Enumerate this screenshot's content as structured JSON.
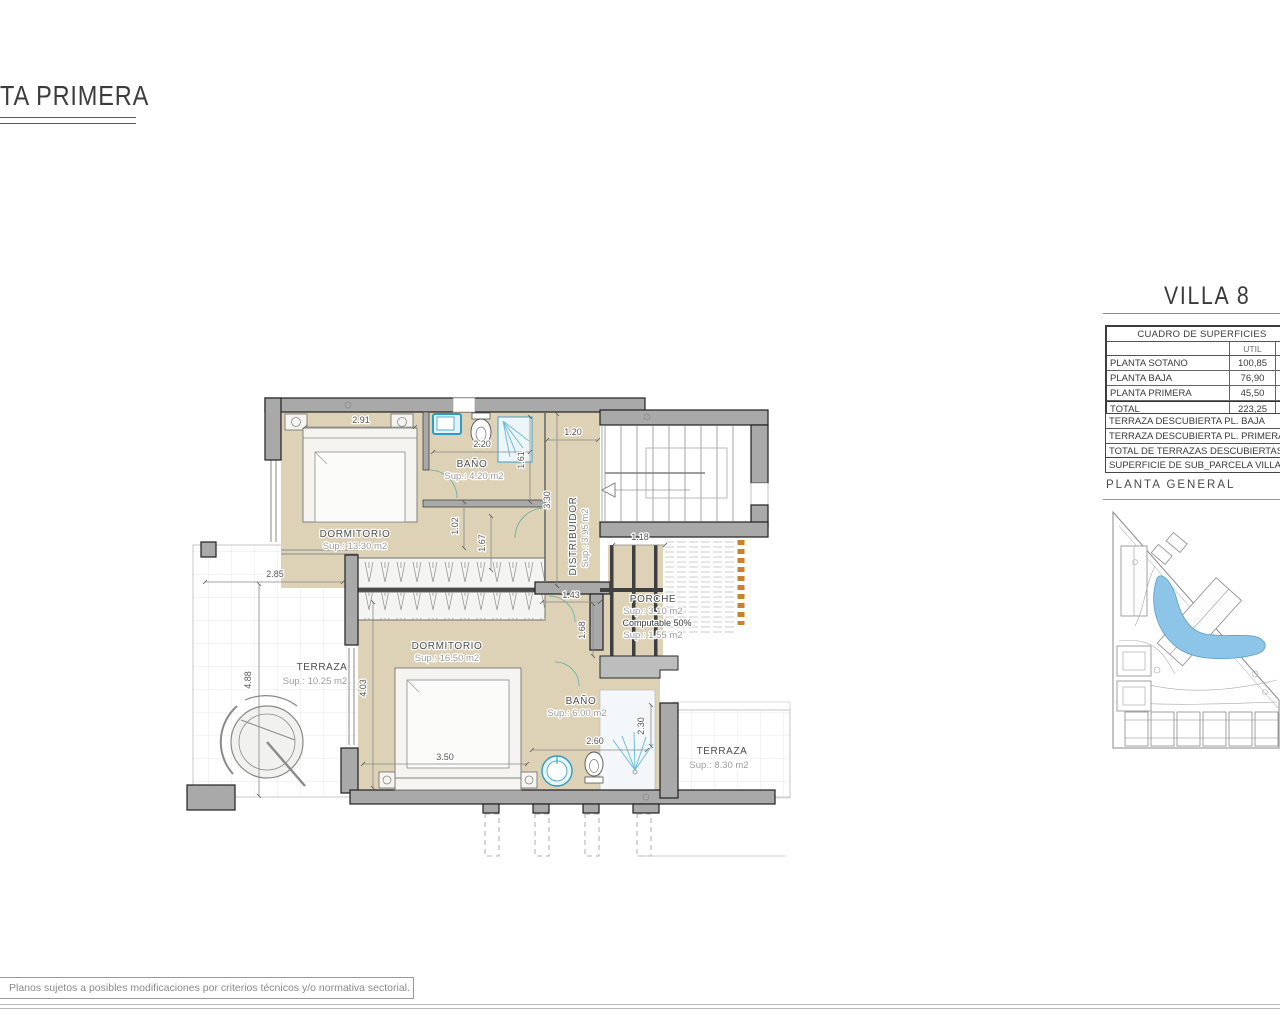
{
  "sheet": {
    "title": "TA PRIMERA",
    "disclaimer": "Planos sujetos a posibles modificaciones por criterios técnicos y/o normativa sectorial."
  },
  "panel": {
    "villa_title": "VILLA 8",
    "surfaces_table": {
      "title": "CUADRO DE SUPERFICIES",
      "col_util": "UTIL",
      "rows": [
        {
          "label": "PLANTA SOTANO",
          "util": "100,85"
        },
        {
          "label": "PLANTA BAJA",
          "util": "76,90"
        },
        {
          "label": "PLANTA PRIMERA",
          "util": "45,50"
        },
        {
          "label": "TOTAL",
          "util": "223,25"
        }
      ]
    },
    "terrace_rows": [
      {
        "label": "TERRAZA DESCUBIERTA PL. BAJA"
      },
      {
        "label": "TERRAZA DESCUBIERTA PL. PRIMERA"
      },
      {
        "label": "TOTAL DE TERRAZAS DESCUBIERTAS"
      }
    ],
    "parcel_row": "SUPERFICIE DE SUB_PARCELA VILLA",
    "planta_general_label": "PLANTA GENERAL"
  },
  "plan": {
    "rooms": {
      "dorm1": {
        "name": "DORMITORIO",
        "sup": "Sup.: 13.30  m2"
      },
      "bath1": {
        "name": "BAÑO",
        "sup": "Sup.: 4.20    m2"
      },
      "distribuidor": {
        "name": "DISTRIBUIDOR",
        "sup": "Sup.: 3.95  m2"
      },
      "dorm2": {
        "name": "DORMITORIO",
        "sup": "Sup.: 16.50  m2"
      },
      "bath2": {
        "name": "BAÑO",
        "sup": "Sup.: 6.00   m2"
      },
      "terrace_left": {
        "name": "TERRAZA",
        "sup": "Sup.: 10.25  m2"
      },
      "terrace_right": {
        "name": "TERRAZA",
        "sup": "Sup.: 8.30   m2"
      },
      "porch": {
        "name": "PORCHE",
        "sup": "Sup.: 3.10   m2",
        "note": "Computable 50%",
        "sup2": "Sup.: 1.55   m2"
      }
    },
    "dims": {
      "bed1_width": "2.91",
      "bath1_width": "2.20",
      "distrib_width": "1.20",
      "shower1_height": "1.61",
      "distrib_height": "3.30",
      "hall1": "1.02",
      "hall2": "1.67",
      "terraceL_width": "2.85",
      "terraceL_height": "4.88",
      "dorm2_door": "1.43",
      "porch_width": "1.18",
      "hall3": "1.68",
      "dorm2_height": "4.03",
      "dorm2_width": "3.50",
      "bath2_width": "2.60",
      "shower2_height": "2.30"
    }
  },
  "colors": {
    "floor_beige": "#ddd1b6",
    "wall_gray": "#a9a9a9",
    "fixture_blue": "#2d9cc4",
    "pergola_orange": "#c9812f",
    "pool_blue": "#8cc5e8"
  }
}
